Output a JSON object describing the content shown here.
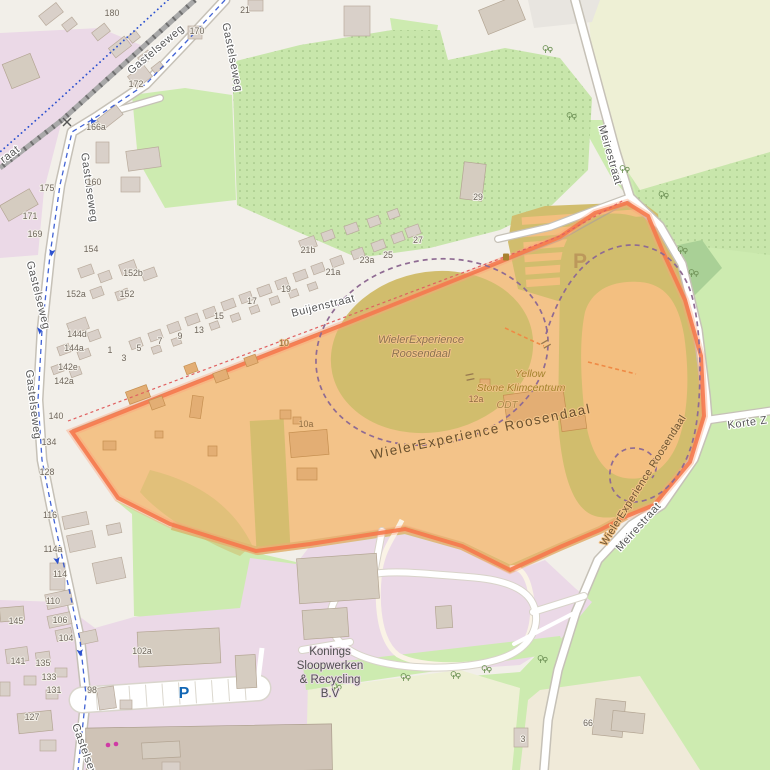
{
  "map": {
    "region_description": "WielerExperience Roosendaal cycling park and surroundings",
    "colors": {
      "base": "#f2efe9",
      "pink": "#ebd9e7",
      "grass": "#cdebb0",
      "scrub": "#c8e6ab",
      "scrubDot": "#8fb475",
      "farmland": "#eef0d5",
      "forest": "#a9d096",
      "farmyard": "#f0ead9",
      "greyLot": "#e8e5e0",
      "road": "#ffffff",
      "roadCase": "#c6c1b7",
      "rail": "#a9a9a9",
      "railDark": "#6f6f6f",
      "orange": "#f3bf80",
      "khaki": "#d1bd6d",
      "building": "#d9d0c9",
      "buildingTan": "#e3ae74",
      "border": "#f5794e",
      "cycle": "#2d52cf",
      "purple": "#8f6b93",
      "red": "#e06060",
      "pblue": "#1267b5",
      "labelGrey": "#575757",
      "pathBrown": "#6b5230",
      "poiYellow": "#a3832c",
      "magenta": "#cf3ba5"
    },
    "labels": [
      {
        "t": "Gastelseweg",
        "x": 229,
        "y": 58,
        "r": 79,
        "c": "street"
      },
      {
        "t": "Gastelseweg",
        "x": 158,
        "y": 52,
        "r": -40,
        "c": "street"
      },
      {
        "t": "Gastelseweg",
        "x": 86,
        "y": 188,
        "r": 82,
        "c": "street"
      },
      {
        "t": "Gastelseweg",
        "x": 35,
        "y": 296,
        "r": 76,
        "c": "street"
      },
      {
        "t": "Gastelseweg",
        "x": 30,
        "y": 405,
        "r": 83,
        "c": "street"
      },
      {
        "t": "Gastelseweg",
        "x": 84,
        "y": 758,
        "r": 70,
        "c": "street"
      },
      {
        "t": "raat",
        "x": 12,
        "y": 157,
        "r": -37,
        "c": "street"
      },
      {
        "t": "Buijenstraat",
        "x": 324,
        "y": 309,
        "r": -14,
        "c": "street"
      },
      {
        "t": "Meirestraat",
        "x": 607,
        "y": 156,
        "r": 74,
        "c": "street"
      },
      {
        "t": "Meirestraat",
        "x": 641,
        "y": 529,
        "r": -48,
        "c": "street"
      },
      {
        "t": "Korte Z",
        "x": 748,
        "y": 426,
        "r": -8,
        "c": "street"
      },
      {
        "t": "WielerExperience Roosendaal",
        "x": 482,
        "y": 436,
        "r": -12,
        "c": "wl"
      },
      {
        "t": "WielerExperience Roosendaal",
        "x": 646,
        "y": 482,
        "r": -58,
        "c": "wl2"
      },
      {
        "t": "WielerExperience",
        "x": 421,
        "y": 343,
        "r": 0,
        "c": "area"
      },
      {
        "t": "Roosendaal",
        "x": 421,
        "y": 357,
        "r": 0,
        "c": "area"
      },
      {
        "t": "Yellow",
        "x": 530,
        "y": 377,
        "r": 0,
        "c": "poi"
      },
      {
        "t": "Stone Klimcentrum",
        "x": 521,
        "y": 391,
        "r": 0,
        "c": "poi"
      },
      {
        "t": "ODT",
        "x": 507,
        "y": 408,
        "r": 0,
        "c": "odt"
      },
      {
        "t": "Konings",
        "x": 330,
        "y": 655,
        "r": 0,
        "c": "ind"
      },
      {
        "t": "Sloopwerken",
        "x": 330,
        "y": 669,
        "r": 0,
        "c": "ind"
      },
      {
        "t": "& Recycling",
        "x": 330,
        "y": 683,
        "r": 0,
        "c": "ind"
      },
      {
        "t": "B.V",
        "x": 330,
        "y": 697,
        "r": 0,
        "c": "ind"
      },
      {
        "t": "P",
        "x": 580,
        "y": 268,
        "r": 0,
        "c": "pbig"
      },
      {
        "t": "P",
        "x": 184,
        "y": 698,
        "r": 0,
        "c": "pblue"
      }
    ],
    "house_numbers": [
      {
        "t": "180",
        "x": 112,
        "y": 16
      },
      {
        "t": "21",
        "x": 245,
        "y": 13
      },
      {
        "t": "170",
        "x": 197,
        "y": 34
      },
      {
        "t": "172",
        "x": 136,
        "y": 87
      },
      {
        "t": "166a",
        "x": 96,
        "y": 130
      },
      {
        "t": "160",
        "x": 94,
        "y": 185
      },
      {
        "t": "175",
        "x": 47,
        "y": 191
      },
      {
        "t": "171",
        "x": 30,
        "y": 219
      },
      {
        "t": "169",
        "x": 35,
        "y": 237
      },
      {
        "t": "154",
        "x": 91,
        "y": 252
      },
      {
        "t": "152b",
        "x": 133,
        "y": 276
      },
      {
        "t": "152a",
        "x": 76,
        "y": 297
      },
      {
        "t": "152",
        "x": 127,
        "y": 297
      },
      {
        "t": "144d",
        "x": 77,
        "y": 337
      },
      {
        "t": "144a",
        "x": 74,
        "y": 351
      },
      {
        "t": "142e",
        "x": 68,
        "y": 370
      },
      {
        "t": "142a",
        "x": 64,
        "y": 384
      },
      {
        "t": "140",
        "x": 56,
        "y": 419
      },
      {
        "t": "134",
        "x": 49,
        "y": 445
      },
      {
        "t": "128",
        "x": 47,
        "y": 475
      },
      {
        "t": "116",
        "x": 50,
        "y": 518
      },
      {
        "t": "114a",
        "x": 53,
        "y": 552
      },
      {
        "t": "114",
        "x": 60,
        "y": 577
      },
      {
        "t": "110",
        "x": 53,
        "y": 604
      },
      {
        "t": "106",
        "x": 60,
        "y": 623
      },
      {
        "t": "104",
        "x": 66,
        "y": 641
      },
      {
        "t": "145",
        "x": 16,
        "y": 624
      },
      {
        "t": "141",
        "x": 18,
        "y": 664
      },
      {
        "t": "135",
        "x": 43,
        "y": 666
      },
      {
        "t": "133",
        "x": 49,
        "y": 680
      },
      {
        "t": "131",
        "x": 54,
        "y": 693
      },
      {
        "t": "127",
        "x": 32,
        "y": 720
      },
      {
        "t": "98",
        "x": 92,
        "y": 693
      },
      {
        "t": "102a",
        "x": 142,
        "y": 654
      },
      {
        "t": "66",
        "x": 588,
        "y": 726
      },
      {
        "t": "3",
        "x": 523,
        "y": 742
      },
      {
        "t": "29",
        "x": 478,
        "y": 200
      },
      {
        "t": "27",
        "x": 418,
        "y": 243
      },
      {
        "t": "25",
        "x": 388,
        "y": 258
      },
      {
        "t": "23a",
        "x": 367,
        "y": 263
      },
      {
        "t": "21a",
        "x": 333,
        "y": 275
      },
      {
        "t": "21b",
        "x": 308,
        "y": 253
      },
      {
        "t": "19",
        "x": 286,
        "y": 292
      },
      {
        "t": "17",
        "x": 252,
        "y": 304
      },
      {
        "t": "15",
        "x": 219,
        "y": 319
      },
      {
        "t": "13",
        "x": 199,
        "y": 333
      },
      {
        "t": "9",
        "x": 180,
        "y": 339
      },
      {
        "t": "7",
        "x": 160,
        "y": 344
      },
      {
        "t": "5",
        "x": 139,
        "y": 351
      },
      {
        "t": "3",
        "x": 124,
        "y": 361
      },
      {
        "t": "1",
        "x": 110,
        "y": 353
      }
    ],
    "house_numbers_highlight": [
      {
        "t": "10",
        "x": 284,
        "y": 346
      },
      {
        "t": "10a",
        "x": 306,
        "y": 427
      },
      {
        "t": "12a",
        "x": 476,
        "y": 402
      }
    ],
    "buildings": [
      [
        40,
        8,
        22,
        12,
        -38,
        0
      ],
      [
        63,
        20,
        13,
        9,
        -38,
        0
      ],
      [
        93,
        27,
        16,
        10,
        -38,
        0
      ],
      [
        110,
        41,
        20,
        12,
        -38,
        0
      ],
      [
        129,
        33,
        10,
        8,
        -38,
        0
      ],
      [
        139,
        53,
        13,
        9,
        -38,
        0
      ],
      [
        152,
        64,
        11,
        7,
        -38,
        0
      ],
      [
        6,
        58,
        30,
        26,
        -22,
        2
      ],
      [
        2,
        196,
        34,
        18,
        -30,
        2
      ],
      [
        344,
        6,
        26,
        30,
        0,
        0
      ],
      [
        248,
        0,
        15,
        11,
        0,
        0
      ],
      [
        188,
        26,
        14,
        13,
        0,
        0
      ],
      [
        130,
        69,
        20,
        15,
        -38,
        0
      ],
      [
        98,
        111,
        24,
        12,
        -38,
        0
      ],
      [
        96,
        142,
        13,
        21,
        0,
        0
      ],
      [
        127,
        149,
        33,
        20,
        -8,
        0
      ],
      [
        121,
        177,
        19,
        15,
        0,
        0
      ],
      [
        79,
        266,
        14,
        10,
        -20,
        0
      ],
      [
        99,
        272,
        12,
        9,
        -20,
        0
      ],
      [
        120,
        262,
        16,
        11,
        -20,
        0
      ],
      [
        142,
        269,
        14,
        10,
        -20,
        0
      ],
      [
        91,
        288,
        12,
        9,
        -20,
        0
      ],
      [
        116,
        290,
        13,
        9,
        -20,
        0
      ],
      [
        68,
        320,
        20,
        12,
        -20,
        0
      ],
      [
        88,
        331,
        12,
        9,
        -20,
        0
      ],
      [
        58,
        345,
        12,
        9,
        -20,
        0
      ],
      [
        78,
        350,
        12,
        8,
        -20,
        0
      ],
      [
        52,
        365,
        11,
        8,
        -20,
        0
      ],
      [
        70,
        368,
        11,
        8,
        -20,
        0
      ],
      [
        130,
        339,
        12,
        9,
        -20,
        0
      ],
      [
        149,
        331,
        13,
        9,
        -20,
        0
      ],
      [
        168,
        323,
        12,
        9,
        -20,
        0
      ],
      [
        186,
        315,
        13,
        9,
        -20,
        0
      ],
      [
        204,
        308,
        12,
        9,
        -20,
        0
      ],
      [
        222,
        300,
        13,
        9,
        -20,
        0
      ],
      [
        240,
        293,
        12,
        9,
        -20,
        0
      ],
      [
        258,
        286,
        13,
        9,
        -20,
        0
      ],
      [
        276,
        279,
        12,
        9,
        -20,
        0
      ],
      [
        294,
        271,
        13,
        9,
        -20,
        0
      ],
      [
        312,
        264,
        12,
        9,
        -20,
        0
      ],
      [
        331,
        257,
        12,
        9,
        -20,
        0
      ],
      [
        352,
        249,
        12,
        9,
        -20,
        0
      ],
      [
        372,
        241,
        13,
        9,
        -20,
        0
      ],
      [
        392,
        233,
        12,
        9,
        -20,
        0
      ],
      [
        152,
        346,
        9,
        7,
        -20,
        0
      ],
      [
        172,
        338,
        9,
        7,
        -20,
        0
      ],
      [
        210,
        322,
        9,
        7,
        -20,
        0
      ],
      [
        231,
        314,
        9,
        7,
        -20,
        0
      ],
      [
        250,
        306,
        9,
        7,
        -20,
        0
      ],
      [
        270,
        297,
        9,
        7,
        -20,
        0
      ],
      [
        289,
        290,
        9,
        7,
        -20,
        0
      ],
      [
        308,
        283,
        9,
        7,
        -20,
        0
      ],
      [
        300,
        238,
        16,
        11,
        -20,
        0
      ],
      [
        322,
        231,
        12,
        9,
        -20,
        0
      ],
      [
        345,
        224,
        13,
        9,
        -20,
        0
      ],
      [
        368,
        217,
        12,
        9,
        -20,
        0
      ],
      [
        406,
        226,
        14,
        10,
        -20,
        0
      ],
      [
        388,
        210,
        11,
        8,
        -20,
        0
      ],
      [
        462,
        163,
        22,
        37,
        7,
        2
      ],
      [
        482,
        2,
        40,
        26,
        -22,
        2
      ],
      [
        127,
        388,
        22,
        13,
        -20,
        1
      ],
      [
        150,
        398,
        14,
        10,
        -20,
        1
      ],
      [
        103,
        441,
        13,
        9,
        0,
        1
      ],
      [
        155,
        431,
        8,
        7,
        0,
        1
      ],
      [
        208,
        446,
        9,
        10,
        0,
        1
      ],
      [
        191,
        396,
        11,
        22,
        8,
        1
      ],
      [
        185,
        364,
        12,
        9,
        -20,
        1
      ],
      [
        214,
        371,
        14,
        10,
        -20,
        1
      ],
      [
        245,
        356,
        12,
        9,
        -20,
        1
      ],
      [
        280,
        410,
        11,
        9,
        0,
        1
      ],
      [
        293,
        417,
        8,
        7,
        0,
        1
      ],
      [
        290,
        431,
        38,
        25,
        -5,
        1
      ],
      [
        297,
        468,
        20,
        12,
        0,
        1
      ],
      [
        505,
        391,
        60,
        28,
        -8,
        1
      ],
      [
        561,
        417,
        25,
        13,
        -8,
        1
      ],
      [
        480,
        379,
        10,
        8,
        0,
        1
      ],
      [
        298,
        556,
        80,
        45,
        -4,
        2
      ],
      [
        303,
        609,
        45,
        29,
        -4,
        2
      ],
      [
        436,
        606,
        16,
        22,
        -4,
        2
      ],
      [
        138,
        630,
        82,
        35,
        -3,
        2
      ],
      [
        236,
        655,
        20,
        33,
        -3,
        2
      ],
      [
        86,
        726,
        246,
        46,
        -1,
        3
      ],
      [
        63,
        514,
        25,
        13,
        -12,
        0
      ],
      [
        68,
        533,
        26,
        17,
        -12,
        0
      ],
      [
        94,
        560,
        30,
        21,
        -12,
        0
      ],
      [
        50,
        563,
        15,
        27,
        0,
        0
      ],
      [
        46,
        592,
        26,
        15,
        -12,
        0
      ],
      [
        48,
        614,
        23,
        12,
        -12,
        0
      ],
      [
        56,
        629,
        16,
        11,
        -12,
        0
      ],
      [
        80,
        631,
        17,
        12,
        -12,
        0
      ],
      [
        107,
        524,
        14,
        10,
        -12,
        0
      ],
      [
        98,
        687,
        17,
        22,
        -8,
        0
      ],
      [
        120,
        700,
        12,
        9,
        0,
        0
      ],
      [
        0,
        607,
        24,
        14,
        -5,
        2
      ],
      [
        6,
        648,
        22,
        14,
        -8,
        0
      ],
      [
        36,
        652,
        14,
        11,
        -8,
        0
      ],
      [
        55,
        668,
        12,
        9,
        0,
        0
      ],
      [
        24,
        676,
        12,
        9,
        0,
        0
      ],
      [
        46,
        690,
        12,
        9,
        0,
        0
      ],
      [
        18,
        712,
        34,
        20,
        -6,
        2
      ],
      [
        40,
        740,
        16,
        11,
        0,
        0
      ],
      [
        0,
        682,
        10,
        14,
        0,
        0
      ],
      [
        142,
        742,
        38,
        16,
        -3,
        2
      ],
      [
        162,
        762,
        18,
        10,
        0,
        0
      ],
      [
        594,
        700,
        30,
        36,
        6,
        2
      ],
      [
        612,
        712,
        32,
        20,
        6,
        2
      ],
      [
        514,
        728,
        14,
        19,
        0,
        0
      ]
    ],
    "trees": [
      [
        548,
        50
      ],
      [
        572,
        117
      ],
      [
        683,
        251
      ],
      [
        694,
        274
      ],
      [
        664,
        196
      ],
      [
        625,
        170
      ],
      [
        543,
        660
      ],
      [
        337,
        688
      ],
      [
        406,
        678
      ],
      [
        456,
        676
      ],
      [
        487,
        670
      ]
    ],
    "oneway_arrows": [
      [
        93,
        121,
        25
      ],
      [
        52,
        252,
        8
      ],
      [
        40,
        330,
        5
      ],
      [
        57,
        560,
        -12
      ],
      [
        80,
        652,
        -5
      ]
    ],
    "shop_dots": [
      [
        108,
        745
      ],
      [
        116,
        744
      ]
    ],
    "gates": [
      [
        546,
        344,
        -30
      ],
      [
        470,
        377,
        -12
      ]
    ],
    "level_crossing": [
      67,
      122
    ],
    "amenity_icon": [
      506,
      257
    ]
  }
}
